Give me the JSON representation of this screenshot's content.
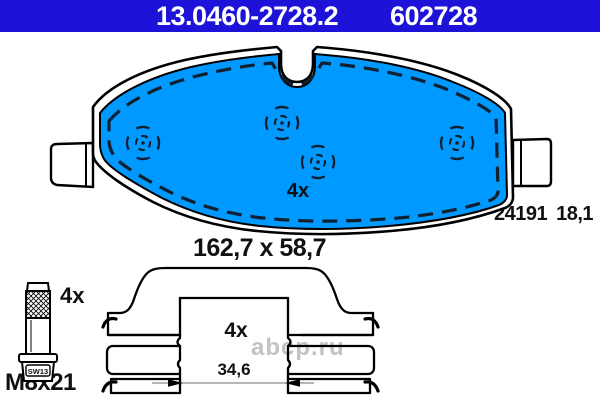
{
  "header": {
    "part_number": "13.0460-2728.2",
    "secondary_number": "602728"
  },
  "pad": {
    "quantity_label": "4x",
    "wva_number": "24191",
    "thickness": "18,1",
    "dimensions": "162,7 x 58,7"
  },
  "bolt": {
    "quantity_label": "4x",
    "size": "M8x21",
    "wrench_size": "SW13"
  },
  "clip": {
    "quantity_label": "4x",
    "inner_width": "34,6"
  },
  "watermark": {
    "text": "abcp.ru"
  },
  "colors": {
    "header_bg": "#1c12d8",
    "pad_fill": "#0099ff",
    "dash_line": "#102030",
    "outline": "#000000",
    "watermark": "#c3c3c3"
  }
}
